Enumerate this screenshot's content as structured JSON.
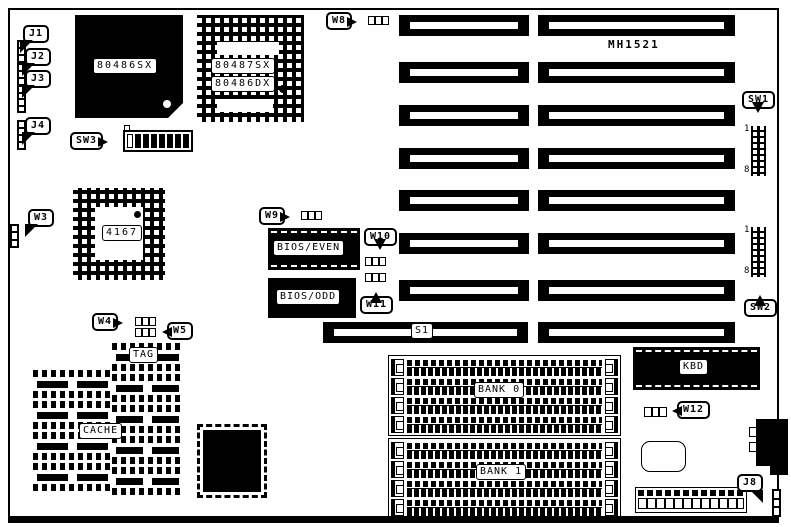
{
  "board": {
    "model": "MH1521"
  },
  "processors": {
    "cpu_label": "80486SX",
    "coprocessor_line1": "80487SX",
    "coprocessor_line2": "80486DX",
    "chipset_label": "4167"
  },
  "bios": {
    "even_label": "BIOS/EVEN",
    "odd_label": "BIOS/ODD"
  },
  "cache": {
    "tag_label": "TAG",
    "cache_label": "CACHE"
  },
  "memory": {
    "bank0_label": "BANK 0",
    "bank1_label": "BANK 1"
  },
  "keyboard": {
    "controller_label": "KBD"
  },
  "connectors": {
    "j1": "J1",
    "j2": "J2",
    "j3": "J3",
    "j4": "J4",
    "j8": "J8",
    "s1": "S1"
  },
  "jumpers": {
    "w3": "W3",
    "w4": "W4",
    "w5": "W5",
    "w8": "W8",
    "w9": "W9",
    "w10": "W10",
    "w11": "W11",
    "w12": "W12"
  },
  "switches": {
    "sw1": "SW1",
    "sw2": "SW2",
    "sw3": "SW3",
    "pin1": "1",
    "pin8": "8"
  }
}
